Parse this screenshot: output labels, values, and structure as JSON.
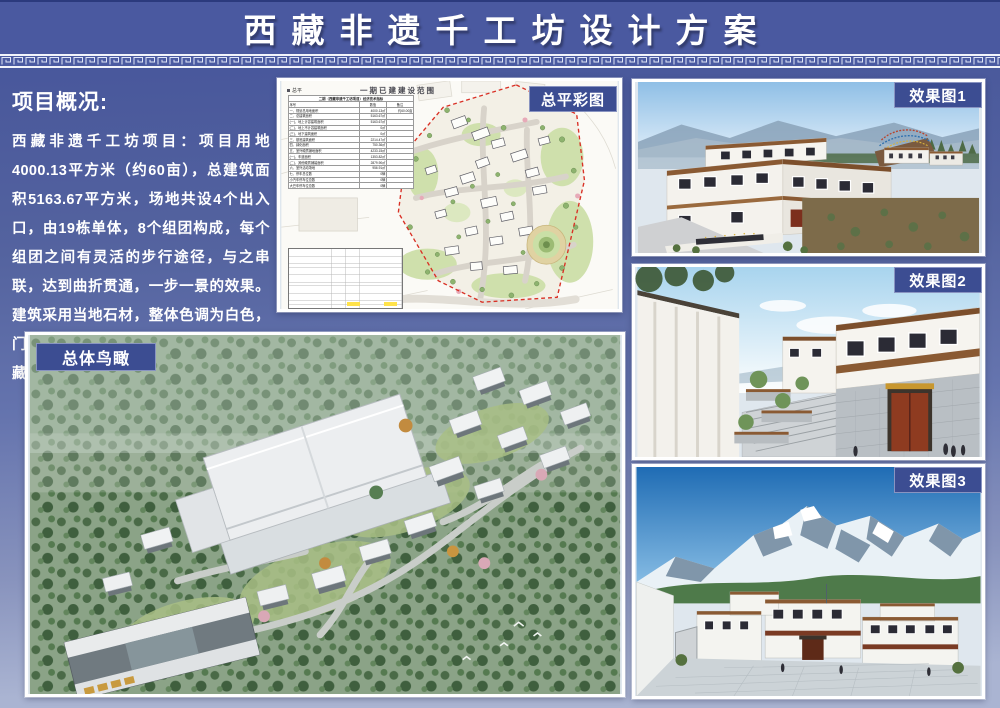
{
  "page": {
    "title": "西藏非遗千工坊设计方案",
    "colors": {
      "background_top": "#47569b",
      "background_bottom": "#aab4d2",
      "label_box": "#3c4d92",
      "table_highlight": "#ffe24a",
      "boundary_red": "#d93025"
    }
  },
  "overview": {
    "heading": "项目概况:",
    "body": "西藏非遗千工坊项目：项目用地4000.13平方米（约60亩），总建筑面积5163.67平方米，场地共设4个出入口，由19栋单体，8个组团构成，每个组团之间有灵活的步行途径，与之串联，达到曲折贯通，一步一景的效果。建筑采用当地石材，整体色调为白色，门窗样式为藏式传统样式，有着浓厚的藏式风味，符合片区的整体风貌。"
  },
  "site_plan": {
    "label": "总平彩图",
    "drawing_title": "一期已建建设范围",
    "legend": "总平",
    "econ_table": {
      "title": "二期（西藏非遗千工坊项目）经济技术指标",
      "columns": [
        "序号",
        "数值",
        "备注"
      ],
      "rows": [
        {
          "name": "一、规划总用地面积",
          "value": "4000.13㎡",
          "note": "约60.00亩"
        },
        {
          "name": "二、总建筑面积",
          "value": "5163.67㎡",
          "note": ""
        },
        {
          "name": "(一)、地上计容建筑面积",
          "value": "5163.67㎡",
          "note": ""
        },
        {
          "name": "(二)、地上不计容建筑面积",
          "value": "0㎡",
          "note": ""
        },
        {
          "name": "(三)、地下建筑面积",
          "value": "0㎡",
          "note": ""
        },
        {
          "name": "三、基底建筑面积",
          "value": "2214.47㎡",
          "note": ""
        },
        {
          "name": "四、绿化面积",
          "value": "750.36㎡",
          "note": ""
        },
        {
          "name": "五、室外硬质铺地面积",
          "value": "4233.15㎡",
          "note": ""
        },
        {
          "name": "(一)、车道面积",
          "value": "1353.82㎡",
          "note": ""
        },
        {
          "name": "(二)、其他硬质铺装面积",
          "value": "2879.90㎡",
          "note": ""
        },
        {
          "name": "六、室外活动场地",
          "value": "956.91㎡",
          "note": ""
        },
        {
          "name": "七、停车总位数",
          "value": "0辆",
          "note": ""
        },
        {
          "name": "小汽车停车位总数",
          "value": "0辆",
          "note": ""
        },
        {
          "name": "大巴车停车位总数",
          "value": "0辆",
          "note": ""
        }
      ]
    }
  },
  "renders": [
    {
      "label": "效果图1"
    },
    {
      "label": "效果图2"
    },
    {
      "label": "效果图3"
    }
  ],
  "aerial": {
    "label": "总体鸟瞰"
  }
}
